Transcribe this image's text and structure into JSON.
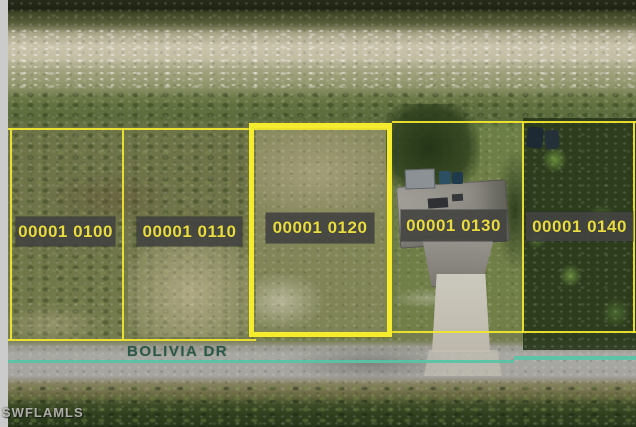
{
  "scene": {
    "type": "aerial-parcel-photo",
    "street_label": "BOLIVIA DR",
    "watermark": "SWFLAMLS"
  },
  "parcels": [
    {
      "label": "00001 0100",
      "highlighted": false
    },
    {
      "label": "00001 0110",
      "highlighted": false
    },
    {
      "label": "00001 0120",
      "highlighted": true
    },
    {
      "label": "00001 0130",
      "highlighted": false
    },
    {
      "label": "00001 0140",
      "highlighted": false
    }
  ],
  "colors": {
    "parcel_boundary": "#f0e52f",
    "highlight_border": "#f5ec2e",
    "label_background": "#424240",
    "label_text": "#e9dc41",
    "street_centerline": "#58c3a5",
    "street_text": "#1e4e3e",
    "watermark_text": "#e1e1da",
    "letterbox_gray": "#cbcbcb"
  }
}
